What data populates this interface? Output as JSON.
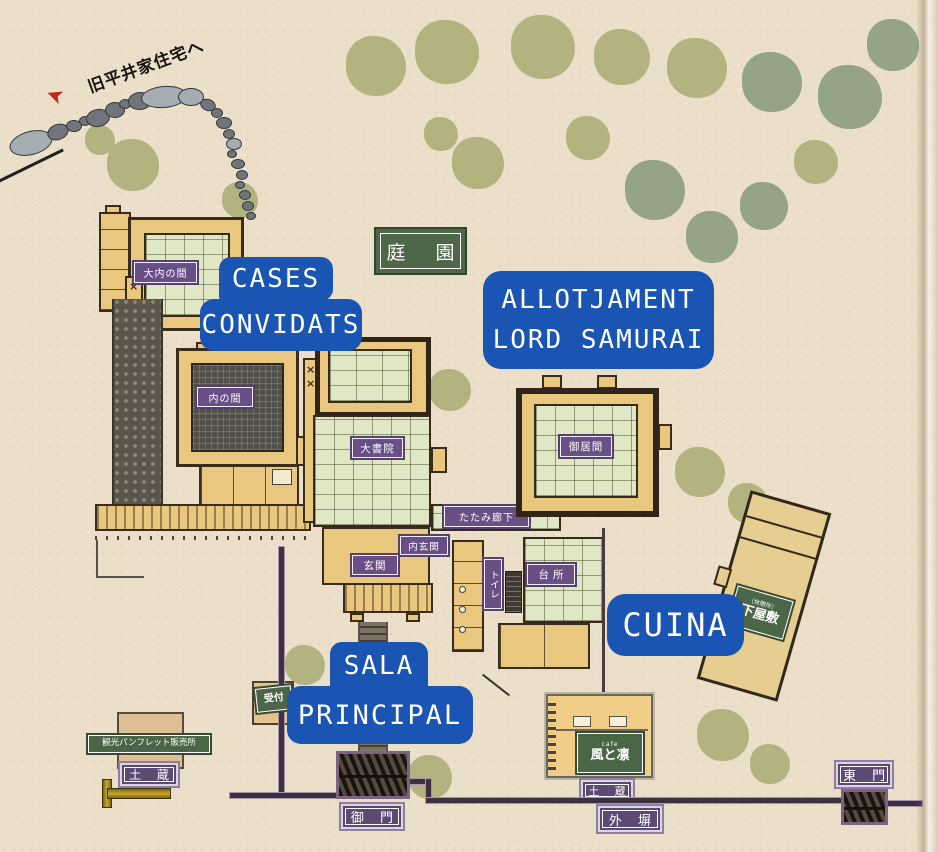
{
  "map": {
    "wayfinding": {
      "to_hirai_house": "旧平井家住宅へ"
    },
    "icons": {
      "direction_arrow": "➤"
    },
    "garden_sign": "庭 園",
    "overlays": {
      "guest_top": "CASES",
      "guest_bottom": "CONVIDATS",
      "lord_line1": "ALLOTJAMENT",
      "lord_line2": "LORD SAMURAI",
      "kitchen": "CUINA",
      "hall_top": "SALA",
      "hall_bottom": "PRINCIPAL"
    },
    "rooms": {
      "great_inner_room": "大内の間",
      "inner_room": "内の間",
      "great_shoin": "大書院",
      "living_room": "御居間",
      "tatami_corridor": "たたみ廊下",
      "inner_entrance": "内玄関",
      "entrance": "玄関",
      "toilet": "トイレ",
      "kitchen": "台所"
    },
    "grounds": {
      "storehouse_west": "土 蔵",
      "storehouse_south": "土 蔵",
      "main_gate": "御 門",
      "outer_wall": "外 塀",
      "east_gate": "東 門"
    },
    "signs": {
      "pamphlet_office": "観光パンフレット販売所",
      "reception": "受付",
      "lower_residence_sub": "（休憩所）",
      "lower_residence": "下屋敷",
      "cafe_sub": "cafe",
      "cafe_name": "風と凛"
    },
    "colors": {
      "label_blue": "#1a55b4",
      "sign_green": "#4b6547",
      "label_purple": "#6a4f86",
      "wall_purple": "#3d3040",
      "tree_light": "#b2b37e",
      "tree_dark": "#95a387",
      "paper": "#ebdfc9"
    }
  }
}
